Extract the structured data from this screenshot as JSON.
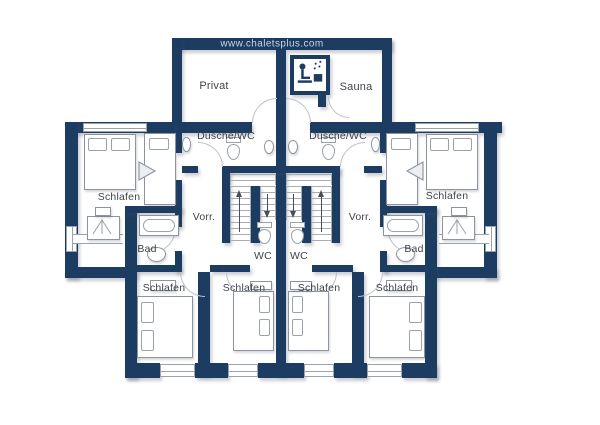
{
  "watermark": "www.chaletsplus.com",
  "colors": {
    "wall": "#1d3c62",
    "line": "#9aa2ab",
    "text": "#3f444a",
    "watermark_text": "#c6d7ea"
  },
  "rooms": [
    {
      "id": "privat",
      "label": "Privat"
    },
    {
      "id": "sauna",
      "label": "Sauna"
    },
    {
      "id": "dusche-wc-left",
      "label": "Dusche/WC"
    },
    {
      "id": "dusche-wc-right",
      "label": "Dusche/WC"
    },
    {
      "id": "schlafen-left",
      "label": "Schlafen"
    },
    {
      "id": "schlafen-right",
      "label": "Schlafen"
    },
    {
      "id": "vorraum-left",
      "label": "Vorr."
    },
    {
      "id": "vorraum-right",
      "label": "Vorr."
    },
    {
      "id": "bad-left",
      "label": "Bad"
    },
    {
      "id": "bad-right",
      "label": "Bad"
    },
    {
      "id": "wc-left",
      "label": "WC"
    },
    {
      "id": "wc-right",
      "label": "WC"
    },
    {
      "id": "schlafen-1",
      "label": "Schlafen"
    },
    {
      "id": "schlafen-2",
      "label": "Schlafen"
    },
    {
      "id": "schlafen-3",
      "label": "Schlafen"
    },
    {
      "id": "schlafen-4",
      "label": "Schlafen"
    }
  ]
}
